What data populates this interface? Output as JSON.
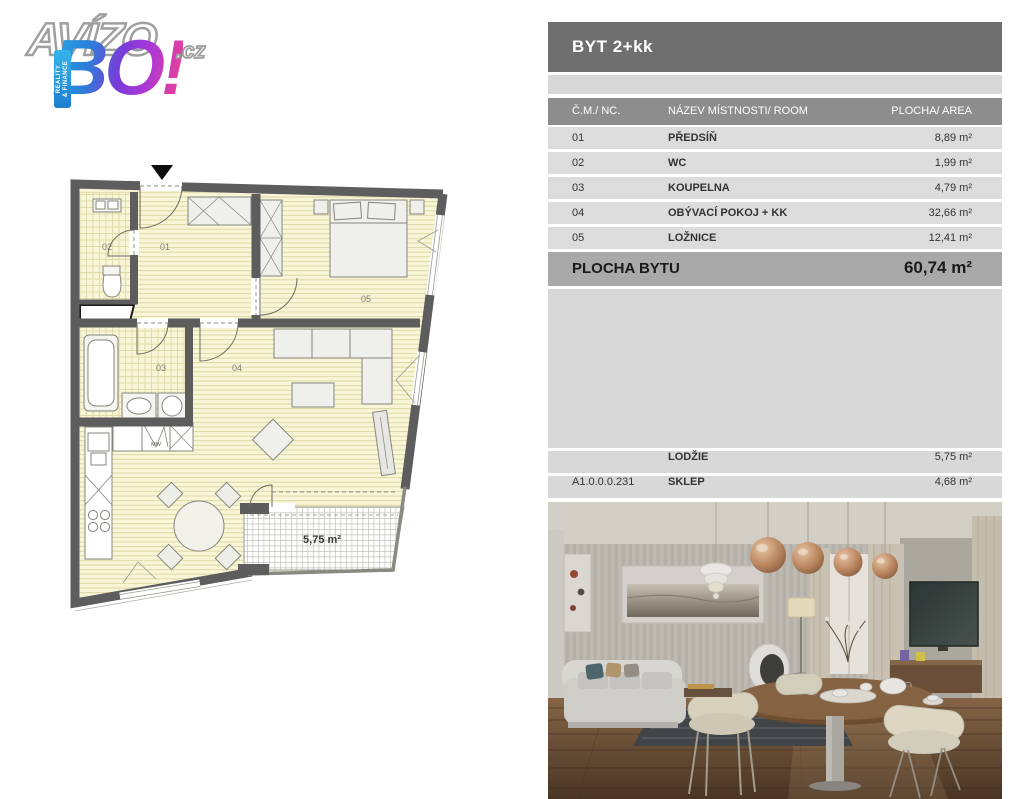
{
  "logo": {
    "brand": "AVÍZO",
    "tld": ".cz",
    "bang": "BO!",
    "tagline_line1": "REALITY",
    "tagline_line2": "& FINANCE",
    "colors": {
      "blue": "#2aa9e6",
      "purple": "#8a38d8",
      "pink": "#e8409a"
    }
  },
  "panel": {
    "title": "BYT 2+kk",
    "header": {
      "no": "Č.M./ NC.",
      "room": "NÁZEV MÍSTNOSTI/ ROOM",
      "area": "PLOCHA/ AREA"
    },
    "rows": [
      {
        "no": "01",
        "room": "PŘEDSÍŇ",
        "area": "8,89 m²"
      },
      {
        "no": "02",
        "room": "WC",
        "area": "1,99 m²"
      },
      {
        "no": "03",
        "room": "KOUPELNA",
        "area": "4,79 m²"
      },
      {
        "no": "04",
        "room": "OBÝVACÍ POKOJ + KK",
        "area": "32,66 m²"
      },
      {
        "no": "05",
        "room": "LOŽNICE",
        "area": "12,41 m²"
      }
    ],
    "total": {
      "label": "PLOCHA BYTU",
      "value": "60,74 m²"
    },
    "extras": [
      {
        "no": "",
        "room": "LODŽIE",
        "area": "5,75 m²"
      },
      {
        "no": "A1.0.0.0.231",
        "room": "SKLEP",
        "area": "4,68 m²"
      }
    ]
  },
  "floorplan": {
    "room_labels": {
      "r01": "01",
      "r02": "02",
      "r03": "03",
      "r04": "04",
      "r05": "05"
    },
    "lodzie_area": "5,75 m²",
    "microwave": "MW",
    "colors": {
      "wall": "#5d5d5d",
      "floor_fill": "#f9f6d8",
      "hatch": "#ddd6a4"
    }
  }
}
